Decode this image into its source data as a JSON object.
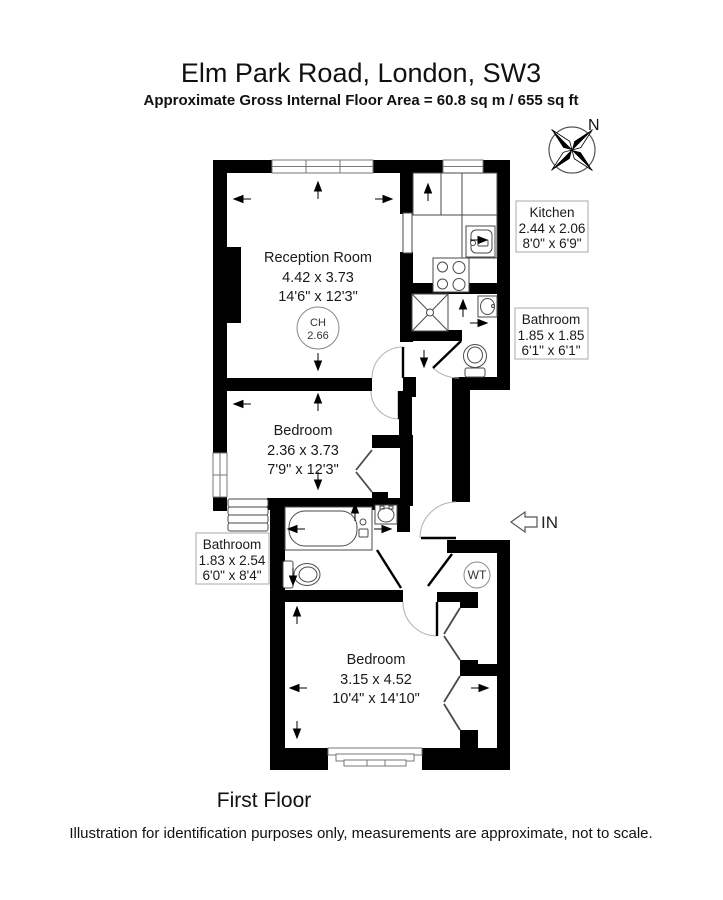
{
  "header": {
    "title": "Elm Park Road, London, SW3",
    "subtitle": "Approximate Gross Internal Floor Area = 60.8 sq m / 655 sq ft"
  },
  "compass": {
    "north_label": "N"
  },
  "rooms": {
    "reception": {
      "name": "Reception Room",
      "metric": "4.42 x 3.73",
      "imperial": "14'6\" x 12'3\""
    },
    "kitchen": {
      "name": "Kitchen",
      "metric": "2.44 x 2.06",
      "imperial": "8'0\" x 6'9\""
    },
    "bathroom_top": {
      "name": "Bathroom",
      "metric": "1.85 x 1.85",
      "imperial": "6'1\" x 6'1\""
    },
    "bedroom_mid": {
      "name": "Bedroom",
      "metric": "2.36 x 3.73",
      "imperial": "7'9\" x 12'3\""
    },
    "bathroom_lower": {
      "name": "Bathroom",
      "metric": "1.83 x 2.54",
      "imperial": "6'0\" x 8'4\""
    },
    "bedroom_bottom": {
      "name": "Bedroom",
      "metric": "3.15 x 4.52",
      "imperial": "10'4\" x 14'10\""
    }
  },
  "annotations": {
    "ceiling_height_label": "CH",
    "ceiling_height_value": "2.66",
    "water_tank_label": "WT",
    "entrance_label": "IN",
    "floor_label": "First Floor",
    "disclaimer": "Illustration for identification purposes only, measurements are approximate, not to scale."
  },
  "colors": {
    "walls": "#000000",
    "fixtures": "#4a4a4a",
    "label_box_border": "#a8a8a8",
    "background": "#ffffff"
  }
}
